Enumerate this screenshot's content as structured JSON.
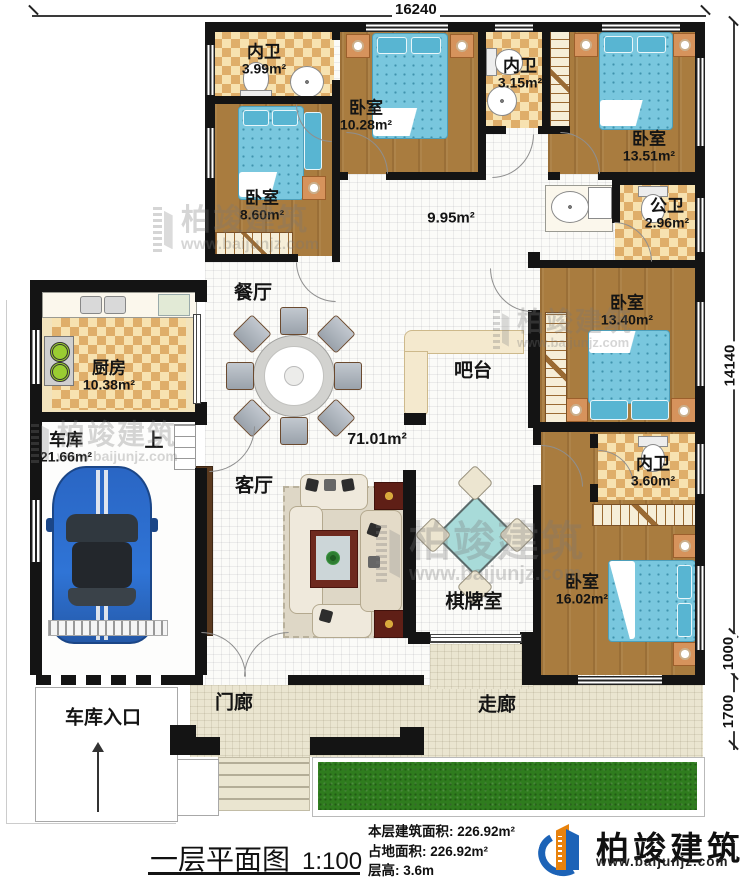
{
  "dimensions": {
    "top_width": "16240",
    "right_height": "14140",
    "right_lower1": "1000",
    "right_lower2": "1700"
  },
  "rooms": {
    "bath_top_left": {
      "name": "内卫",
      "area": "3.99m²"
    },
    "bed_top": {
      "name": "卧室",
      "area": "10.28m²"
    },
    "bath_top_mid": {
      "name": "内卫",
      "area": "3.15m²"
    },
    "bed_top_right": {
      "name": "卧室",
      "area": "13.51m²"
    },
    "bed_left": {
      "name": "卧室",
      "area": "8.60m²"
    },
    "bath_public": {
      "name": "公卫",
      "area": "2.96m²"
    },
    "hallway": {
      "area": "9.95m²"
    },
    "dining": {
      "name": "餐厅"
    },
    "kitchen": {
      "name": "厨房",
      "area": "10.38m²"
    },
    "bar": {
      "name": "吧台"
    },
    "bed_right": {
      "name": "卧室",
      "area": "13.40m²"
    },
    "garage": {
      "name": "车库",
      "area": "21.66m²"
    },
    "stairs": {
      "name": "上"
    },
    "living": {
      "name": "客厅",
      "area": "71.01m²"
    },
    "bath_right": {
      "name": "内卫",
      "area": "3.60m²"
    },
    "bed_bottom_right": {
      "name": "卧室",
      "area": "16.02m²"
    },
    "game_room": {
      "name": "棋牌室"
    },
    "porch": {
      "name": "门廊"
    },
    "corridor": {
      "name": "走廊"
    },
    "garage_entrance": {
      "name": "车库入口"
    }
  },
  "footer": {
    "plan_title": "一层平面图",
    "scale": "1:100",
    "stat_floor_area": "本层建筑面积: 226.92m²",
    "stat_land_area": "占地面积: 226.92m²",
    "stat_height": "层高: 3.6m",
    "brand": "柏竣建筑",
    "website": "www.baijunjz.com"
  },
  "watermark": {
    "brand": "柏竣建筑",
    "website": "www.baijunjz.com"
  },
  "colors": {
    "wall": "#141414",
    "wood_floor": "#a97c3f",
    "tile_light": "#f7e2b0",
    "tile_dark": "#dfae6a",
    "bed_blue": "#79c7de",
    "lawn_green": "#2f7c1e",
    "floor_beige": "#eae5d0",
    "car_blue": "#2a66c4",
    "logo_blue": "#1c63b7",
    "logo_orange": "#e8820c"
  }
}
